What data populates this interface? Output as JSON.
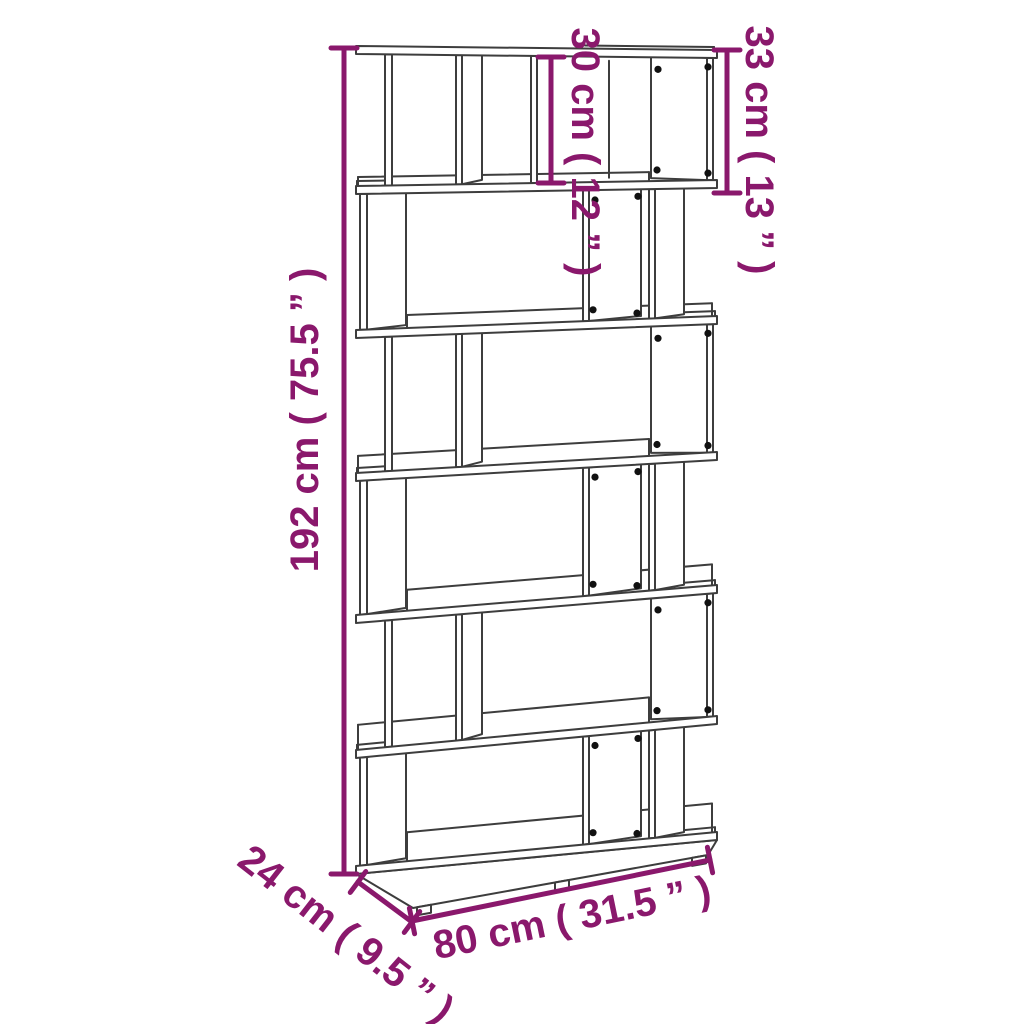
{
  "figure": {
    "name": "bookcase-dimension-diagram",
    "subject": "6-tier zigzag book cabinet / room divider line drawing"
  },
  "dimensions": {
    "height": "192 cm ( 75.5 ” )",
    "compartment_height": "30 cm ( 12 ” )",
    "top_section_height": "33 cm ( 13 ” )",
    "width": "80 cm ( 31.5 ” )",
    "depth": "24 cm ( 9.5 ” )"
  },
  "colors": {
    "dimension": "#8A186C",
    "line_art": "#3D3D3D",
    "connector_dot": "#111111",
    "background": "#FFFFFF"
  }
}
